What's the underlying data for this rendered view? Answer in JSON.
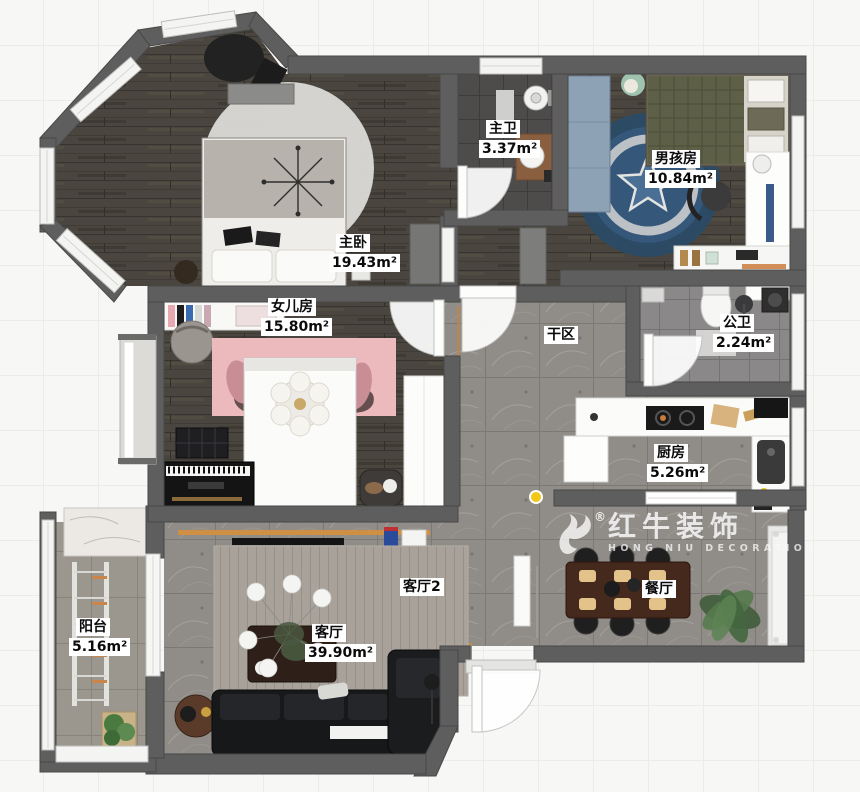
{
  "floorplan": {
    "watermark": {
      "registered": "®",
      "title": "红牛装饰",
      "subtitle": "HONG NIU DECORATION"
    },
    "girls_rug_letters": "d S",
    "rooms": [
      {
        "id": "master-bedroom",
        "name": "主卧",
        "area": "19.43m²",
        "x": 336,
        "y": 234
      },
      {
        "id": "master-bath",
        "name": "主卫",
        "area": "3.37m²",
        "x": 486,
        "y": 120
      },
      {
        "id": "boys-room",
        "name": "男孩房",
        "area": "10.84m²",
        "x": 652,
        "y": 150
      },
      {
        "id": "daughters-room",
        "name": "女儿房",
        "area": "15.80m²",
        "x": 268,
        "y": 298
      },
      {
        "id": "dry-area",
        "name": "干区",
        "area": "",
        "x": 544,
        "y": 326
      },
      {
        "id": "public-bath",
        "name": "公卫",
        "area": "2.24m²",
        "x": 720,
        "y": 314
      },
      {
        "id": "kitchen",
        "name": "厨房",
        "area": "5.26m²",
        "x": 654,
        "y": 444
      },
      {
        "id": "living-room-2",
        "name": "客厅2",
        "area": "",
        "x": 400,
        "y": 578
      },
      {
        "id": "living-room",
        "name": "客厅",
        "area": "39.90m²",
        "x": 312,
        "y": 624
      },
      {
        "id": "dining-room",
        "name": "餐厅",
        "area": "",
        "x": 642,
        "y": 580
      },
      {
        "id": "balcony",
        "name": "阳台",
        "area": "5.16m²",
        "x": 76,
        "y": 618
      }
    ],
    "colors": {
      "wall": "#5e5e5e",
      "wood_floor": "#4a463f",
      "tile_floor": "#908c87",
      "accent_orange": "#cf8f45",
      "boys_rug_blue": "#2f4e68",
      "girls_rug_pink": "#ecb9bd"
    }
  }
}
